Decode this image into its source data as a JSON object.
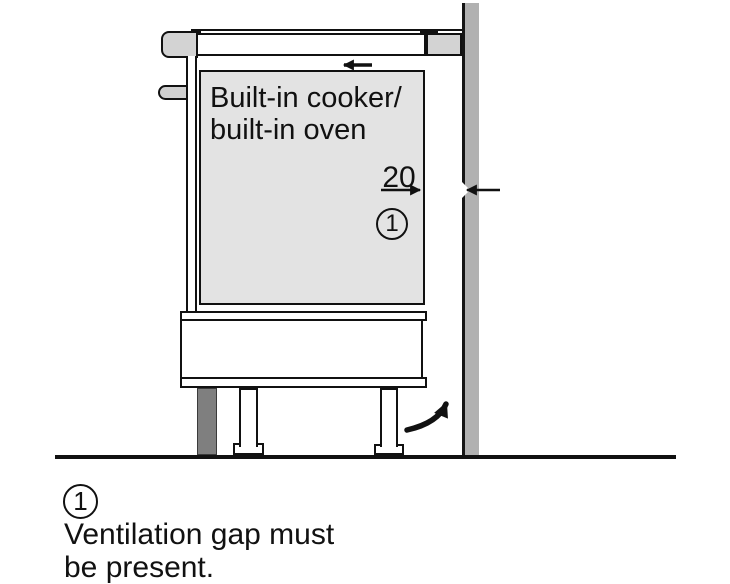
{
  "diagram": {
    "cabinet_label": {
      "line1": "Built-in cooker/",
      "line2": "built-in oven"
    },
    "dimension": {
      "value": "20"
    },
    "callout": {
      "number": "1"
    },
    "legend": {
      "number": "1",
      "text_line1": "Ventilation gap must",
      "text_line2": "be present."
    },
    "colors": {
      "oven_fill": "#e3e3e3",
      "worktop_cap_fill": "#d3d3d3",
      "knob_fill": "#d0d0d0",
      "wall_fill": "#b1b1b1",
      "plinth_fill": "#7f7f7f",
      "line_color": "#111111",
      "background": "#ffffff"
    }
  }
}
